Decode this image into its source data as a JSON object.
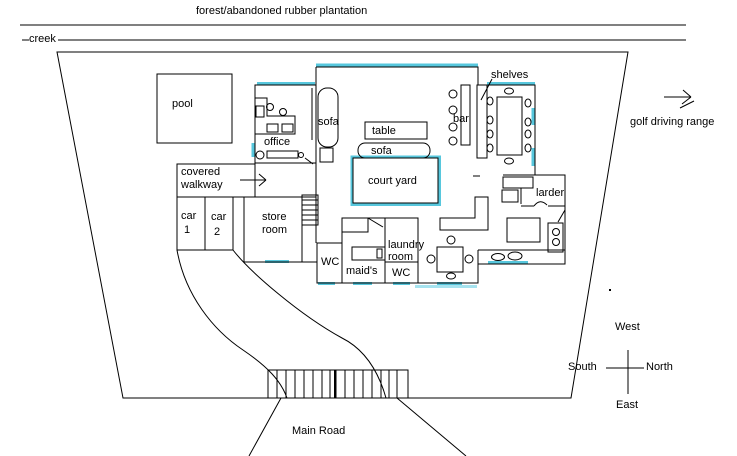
{
  "title": "forest/abandoned rubber plantation",
  "site": {
    "creek": "creek",
    "golf": "golf driving range",
    "main_road": "Main Road"
  },
  "compass": {
    "up": "West",
    "left": "South",
    "right": "North",
    "down": "East"
  },
  "rooms": {
    "pool": "pool",
    "office": "office",
    "covered_walkway": [
      "covered",
      "walkway"
    ],
    "car_1": [
      "car",
      "1"
    ],
    "car_2": [
      "car",
      "2"
    ],
    "store_room": [
      "store",
      "room"
    ],
    "wc_left": "WC",
    "maids": "maid's",
    "laundry_room": [
      "laundry",
      "room"
    ],
    "wc_right": "WC",
    "court_yard": "court yard",
    "larder": "larder"
  },
  "furniture": {
    "sofa_lounge": "sofa",
    "sofa_courtyard": "sofa",
    "table": "table",
    "bar": "bar",
    "shelves": "shelves"
  },
  "colors": {
    "line": "#000000",
    "highlight": "#57c7dd",
    "highlight_light": "#a6e3ef"
  }
}
